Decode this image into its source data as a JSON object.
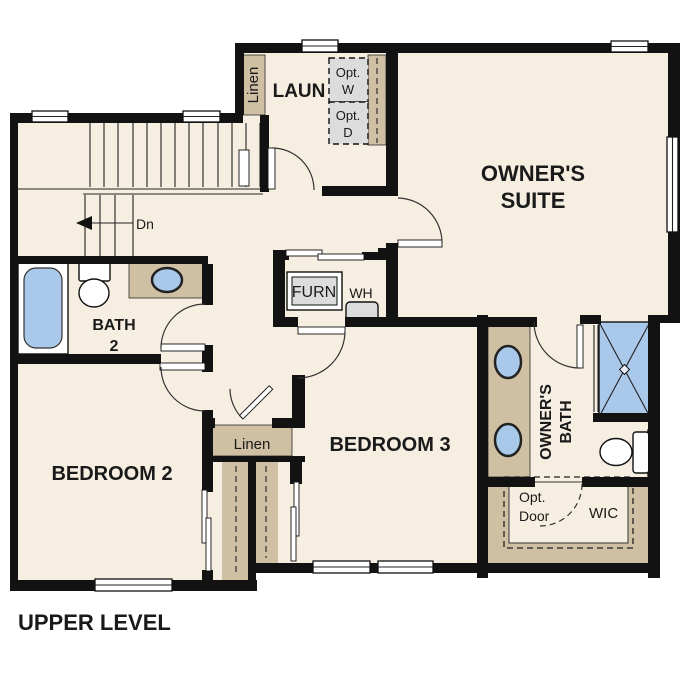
{
  "title": "UPPER LEVEL",
  "colors": {
    "background": "#ffffff",
    "floor": "#f6eee1",
    "cabinet_tan": "#cfc0a4",
    "fixture_blue": "#aac9ea",
    "appliance_gray": "#dcdcdc",
    "wall": "#121212"
  },
  "rooms": {
    "owners_suite": {
      "line1": "OWNER'S",
      "line2": "SUITE"
    },
    "bedroom2": {
      "label": "BEDROOM 2"
    },
    "bedroom3": {
      "label": "BEDROOM 3"
    },
    "bath2": {
      "line1": "BATH",
      "line2": "2"
    },
    "owners_bath": {
      "line1": "OWNER'S",
      "line2": "BATH"
    },
    "laundry": {
      "label": "LAUN"
    },
    "wic": {
      "label": "WIC"
    }
  },
  "labels": {
    "linen_hall": "Linen",
    "linen_laundry": "Linen",
    "furnace": "FURN",
    "water_heater": "WH",
    "opt_washer": {
      "line1": "Opt.",
      "line2": "W"
    },
    "opt_dryer": {
      "line1": "Opt.",
      "line2": "D"
    },
    "opt_door": {
      "line1": "Opt.",
      "line2": "Door"
    },
    "stairs_down": "Dn"
  }
}
